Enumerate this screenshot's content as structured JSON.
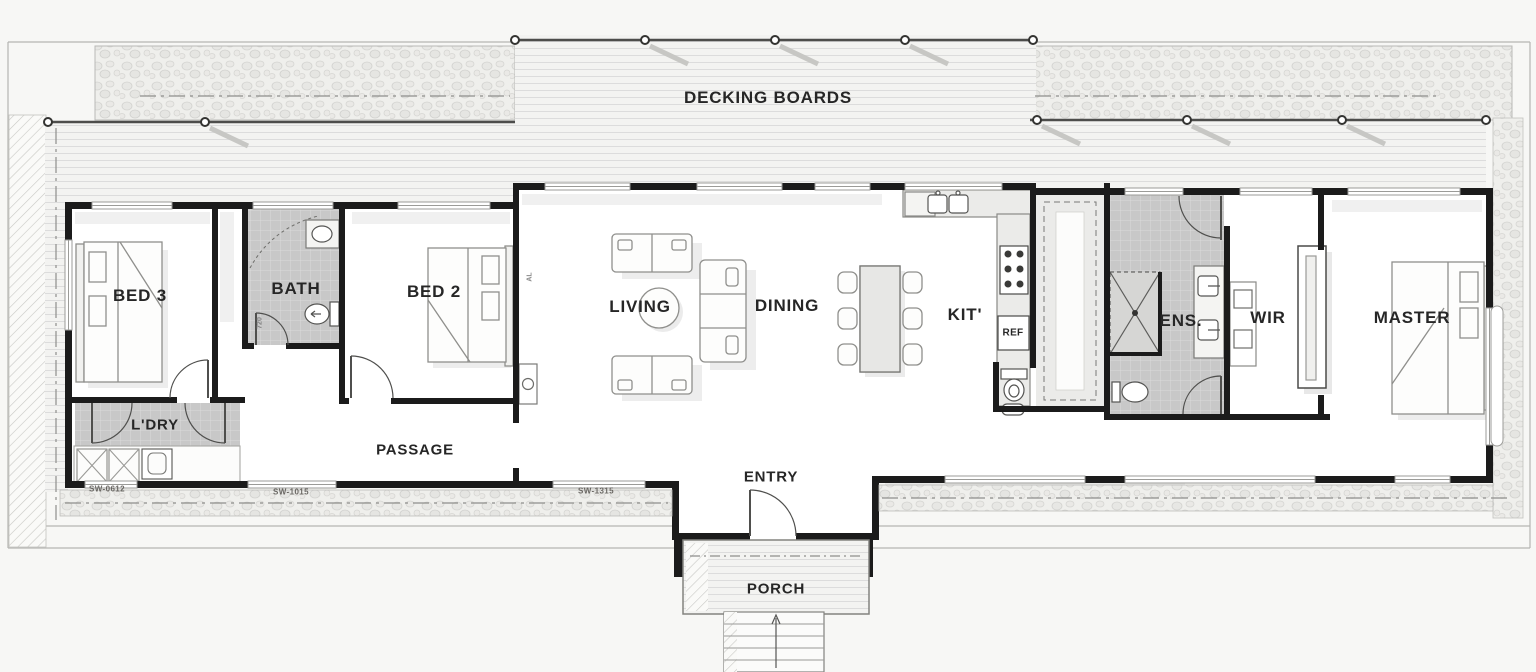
{
  "deck": {
    "label": "DECKING BOARDS"
  },
  "rooms": {
    "bed3": {
      "label": "BED 3"
    },
    "bath": {
      "label": "BATH"
    },
    "bed2": {
      "label": "BED 2"
    },
    "living": {
      "label": "LIVING"
    },
    "dining": {
      "label": "DINING"
    },
    "kitchen": {
      "label": "KIT'"
    },
    "ensuite": {
      "label": "ENS."
    },
    "wir": {
      "label": "WIR"
    },
    "master": {
      "label": "MASTER"
    },
    "laundry": {
      "label": "L'DRY"
    },
    "passage": {
      "label": "PASSAGE"
    },
    "entry": {
      "label": "ENTRY"
    },
    "porch": {
      "label": "PORCH"
    }
  },
  "appliances": {
    "fridge": "REF"
  },
  "window_tags": [
    "SW-0612",
    "SW-1015",
    "SW-1315"
  ],
  "size_tags": {
    "bath_door": "720",
    "window_type": "AL"
  },
  "colors": {
    "wall": "#1b1b1b",
    "paper": "#f7f7f5",
    "tile": "#c8c8c8",
    "deck_line": "#dcdcdc",
    "label_text": "#262626"
  }
}
